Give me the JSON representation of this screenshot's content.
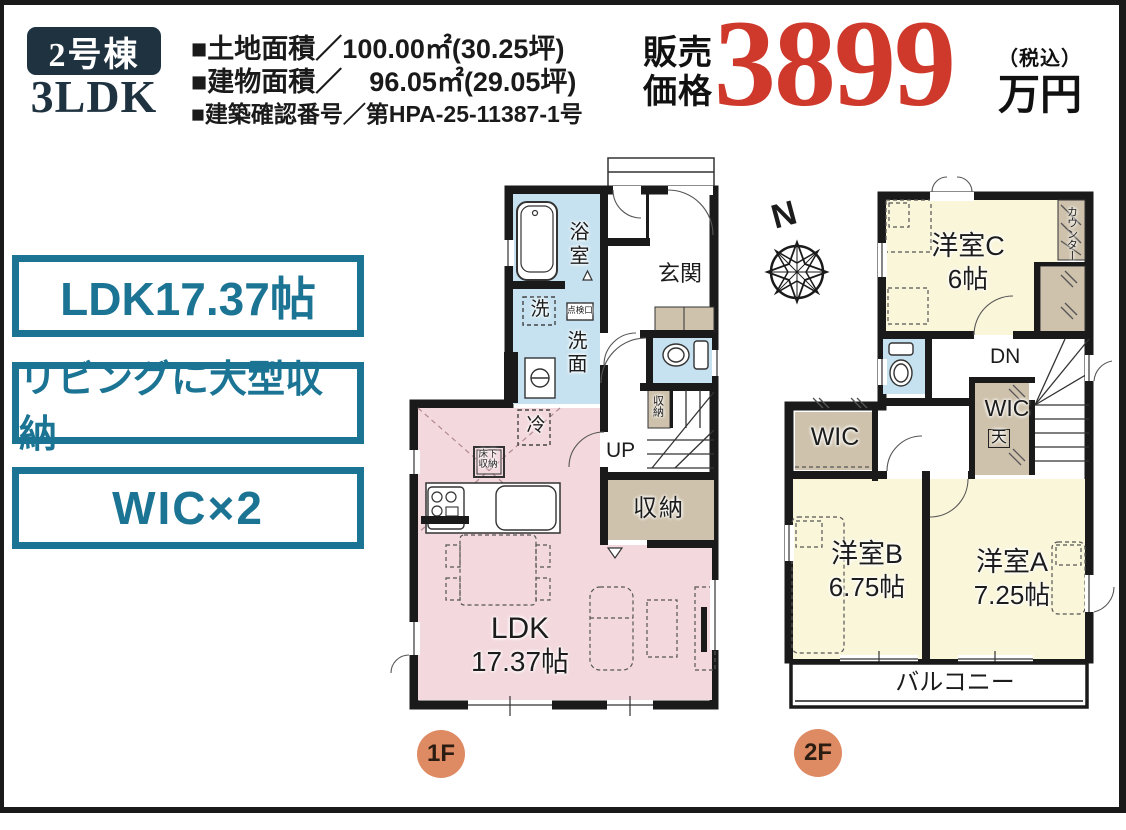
{
  "header": {
    "unit_badge": "2号棟",
    "unit_type": "3LDK",
    "land_area": "■土地面積／100.00㎡(30.25坪)",
    "building_area": "■建物面積／　96.05㎡(29.05坪)",
    "confirmation_no": "■建築確認番号／第HPA-25-11387-1号",
    "price_label": "販売価格",
    "price_value": "3899",
    "price_tax": "（税込）",
    "price_unit": "万円"
  },
  "features": [
    {
      "label": "LDK17.37帖"
    },
    {
      "label": "リビングに大型収納"
    },
    {
      "label": "WIC×2"
    }
  ],
  "floor1": {
    "badge": "1F",
    "labels": {
      "bath": "浴室",
      "washer": "洗",
      "inspection": "点検口",
      "washroom": "洗面",
      "entrance": "玄関",
      "stair_storage": "収納",
      "up": "UP",
      "storage": "収納",
      "fridge": "冷",
      "underfloor": "床下収納",
      "ldk": "LDK",
      "ldk_size": "17.37帖"
    }
  },
  "floor2": {
    "badge": "2F",
    "labels": {
      "north": "N",
      "room_c": "洋室C",
      "room_c_size": "6帖",
      "counter": "カウンター",
      "dn": "DN",
      "wic_left": "WIC",
      "wic_right": "WIC",
      "ceiling": "天",
      "room_b": "洋室B",
      "room_b_size": "6.75帖",
      "room_a": "洋室A",
      "room_a_size": "7.25帖",
      "balcony": "バルコニー"
    }
  },
  "colors": {
    "accent_teal": "#1b7493",
    "badge_navy": "#1f3240",
    "price_red": "#cf392c",
    "room_pink": "#f3d8dd",
    "room_yellow": "#faf6d9",
    "wet_blue": "#c6e2f0",
    "storage_tan": "#cec2ac",
    "floor_badge_orange": "#de8a63",
    "wall_black": "#1a1a1a"
  }
}
